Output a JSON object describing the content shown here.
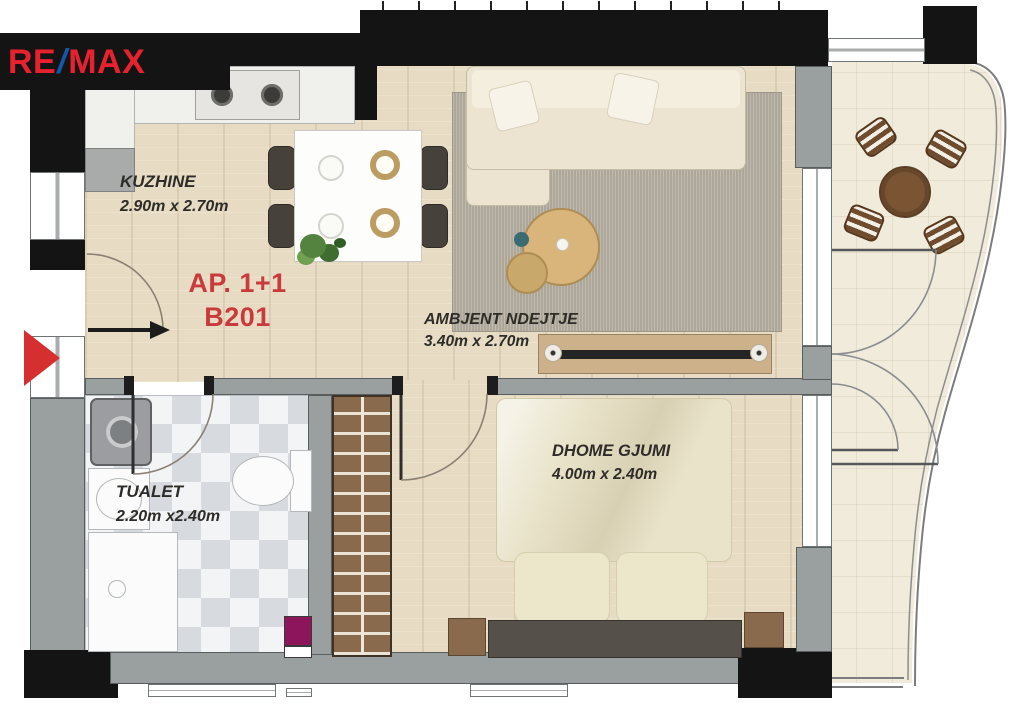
{
  "logo": {
    "re": "RE",
    "slash": "/",
    "max": "MAX"
  },
  "unit": {
    "type_label": "AP. 1+1",
    "number": "B201"
  },
  "rooms": {
    "kitchen": {
      "name": "KUZHINE",
      "dims": "2.90m x 2.70m"
    },
    "living": {
      "name": "AMBJENT NDEJTJE",
      "dims": "3.40m x 2.70m"
    },
    "bathroom": {
      "name": "TUALET",
      "dims": "2.20m x2.40m"
    },
    "bedroom": {
      "name": "DHOME GJUMI",
      "dims": "4.00m x 2.40m"
    }
  },
  "colors": {
    "logo_red": "#e8212f",
    "logo_blue": "#1557a8",
    "unit_label_red": "#c93a3d",
    "wall_black": "#141414",
    "wall_gray": "#9aa0a0",
    "wood_floor": "#e7dcc3",
    "balcony_tile": "#f1ebdb",
    "entrance_arrow_red": "#d62f2f"
  }
}
